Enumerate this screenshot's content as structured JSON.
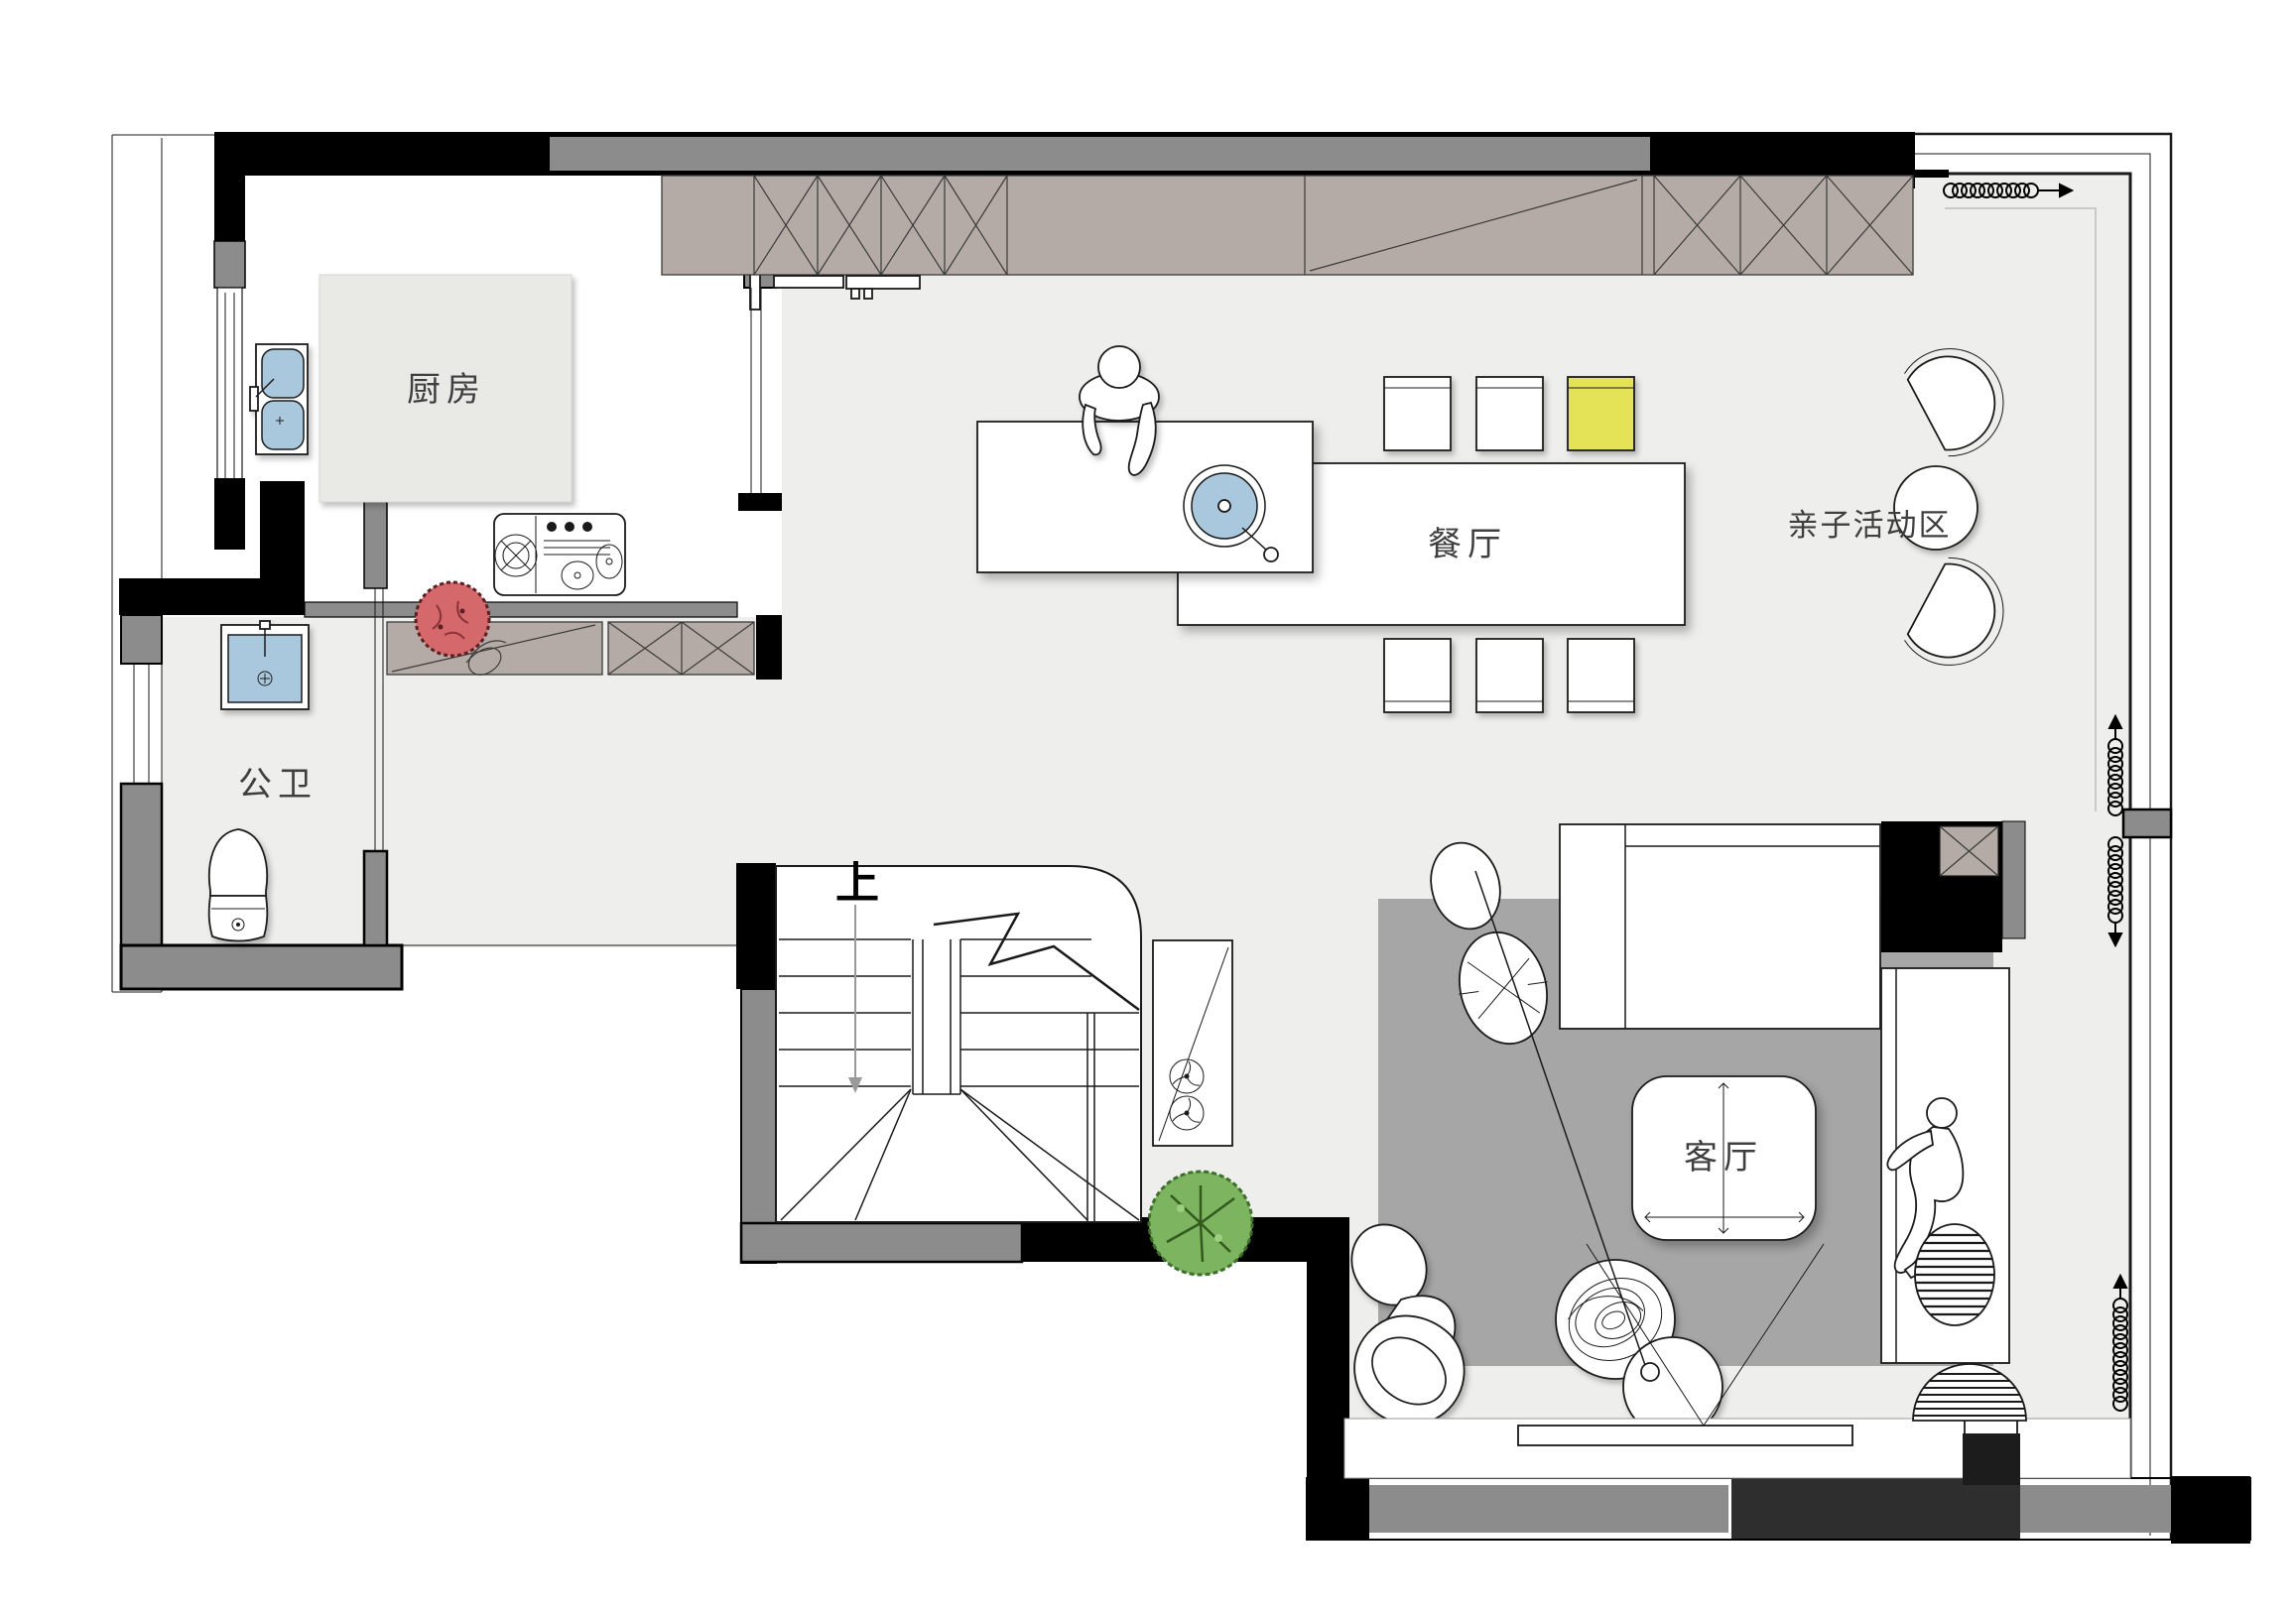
{
  "rooms": {
    "kitchen": {
      "label": "厨房"
    },
    "bathroom": {
      "label": "公卫"
    },
    "dining": {
      "label": "餐厅"
    },
    "living": {
      "label": "客厅"
    },
    "kids_area": {
      "label": "亲子活动区"
    }
  },
  "stairs": {
    "up_label": "上"
  },
  "colors": {
    "wall_black": "#000000",
    "wall_gray": "#8c8c8c",
    "wall_dark": "#2e2e2e",
    "cabinet_taupe": "#b5aba6",
    "floor_light": "#eeefec",
    "rug_gray": "#a6a6a6",
    "fixture_blue": "#a9c7dd",
    "accent_chair_yellow": "#e4e257",
    "plant_red": "#d4686a",
    "plant_green": "#7cb45f"
  },
  "elements": [
    "kitchen-island",
    "kitchen-sink",
    "stove",
    "wardrobe-cabinets",
    "sliding-door",
    "dining-table",
    "island-counter",
    "round-sink",
    "dining-chairs",
    "yellow-chair",
    "kids-chairs",
    "kids-round-table",
    "washbasin",
    "toilet",
    "staircase",
    "up-arrow",
    "fan-cabinet",
    "red-plant",
    "green-plant",
    "rug",
    "sofa",
    "tv-cabinet",
    "chaise",
    "person-standing",
    "person-lying",
    "floor-lamp",
    "wood-table",
    "coffee-table",
    "ottoman-striped",
    "tv",
    "curtain-symbols",
    "window-wall"
  ]
}
